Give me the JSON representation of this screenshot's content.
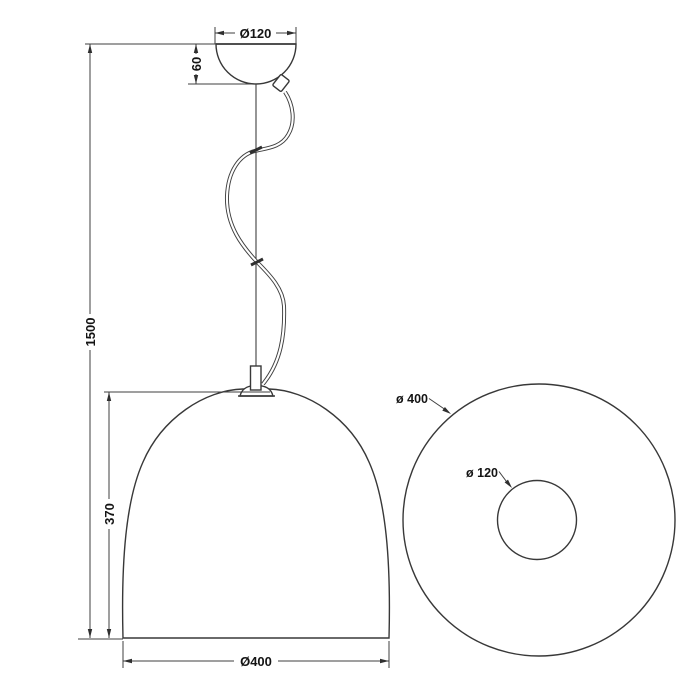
{
  "front_view": {
    "canopy_diameter_label": "Ø120",
    "canopy_height_label": "60",
    "overall_height_label": "1500",
    "shade_height_label": "370",
    "shade_diameter_label": "Ø400"
  },
  "top_view": {
    "outer_diameter_label": "ø 400",
    "inner_diameter_label": "ø 120"
  },
  "colors": {
    "line": "#3f3f3f",
    "text": "#141414",
    "background": "#ffffff"
  }
}
